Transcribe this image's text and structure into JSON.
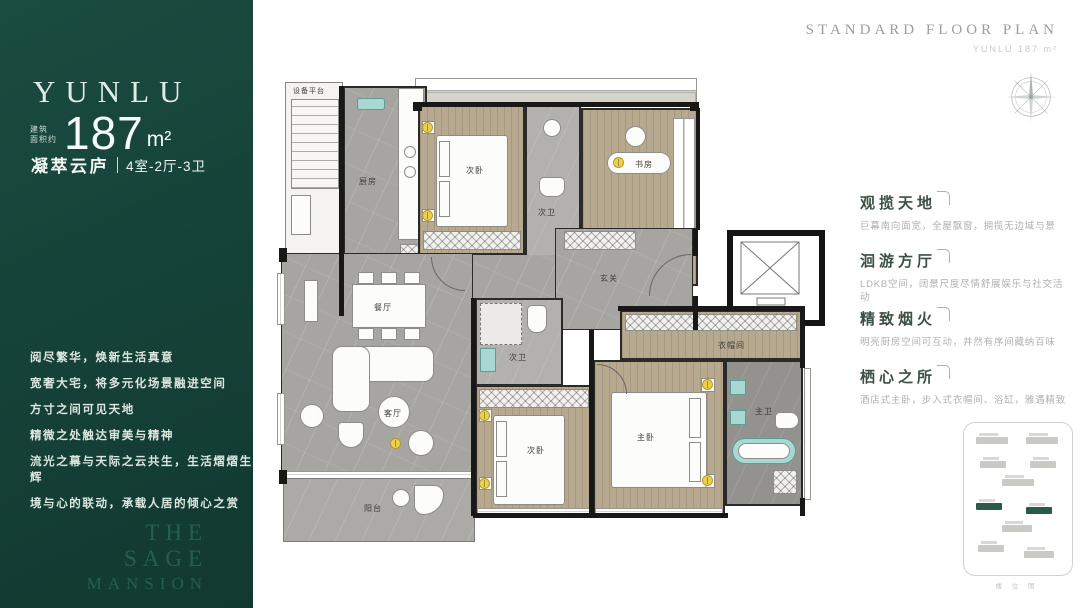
{
  "colors": {
    "sidebar_green": "#16443a",
    "accent_green": "#2a5b49",
    "heading_green": "#3c5044",
    "body_gray": "#b0b0b0",
    "wall": "#181816",
    "marble": "#a6a5a1",
    "wood": "#b7a890",
    "tub_teal": "#a9d8d2",
    "light_yellow": "#ecd04e"
  },
  "sidebar": {
    "brand": "YUNLU",
    "area_label_line1": "建筑",
    "area_label_line2": "面积约",
    "area_value": "187",
    "area_unit": "m²",
    "unit_name": "凝萃云庐",
    "unit_spec": "4室-2厅-3卫",
    "poem": [
      "阅尽繁华，焕新生活真意",
      "宽奢大宅，将多元化场景融进空间",
      "方寸之间可见天地",
      "精微之处触达审美与精神",
      "流光之幕与天际之云共生，生活熠熠生辉",
      "境与心的联动，承载人居的倾心之赏"
    ],
    "watermark_line1": "THE SAGE",
    "watermark_line2": "MANSION"
  },
  "header": {
    "title": "STANDARD FLOOR PLAN",
    "subtitle": "YUNLU 187 m²"
  },
  "features": [
    {
      "title": "观揽天地",
      "desc": "巨幕南向面宽，全屋飘窗，拥揽无边域与景"
    },
    {
      "title": "洄游方厅",
      "desc": "LDKB空间，阔景尺度尽情舒展娱乐与社交活动"
    },
    {
      "title": "精致烟火",
      "desc": "明亮厨房空间可互动，井然有序间藏纳百味"
    },
    {
      "title": "栖心之所",
      "desc": "酒店式主卧，步入式衣帽间、浴缸，雅遇精致"
    }
  ],
  "floorplan": {
    "rooms": {
      "equipment": "设备平台",
      "kitchen": "厨房",
      "bedroom_top": "次卧",
      "bath_top": "次卫",
      "study": "书房",
      "foyer": "玄关",
      "dining": "餐厅",
      "living": "客厅",
      "bath_mid": "次卫",
      "bedroom_bottom": "次卧",
      "closet": "衣帽间",
      "master": "主卧",
      "master_bath": "主卫",
      "balcony": "阳台"
    }
  },
  "minimap": {
    "caption": "楼 位 图"
  }
}
